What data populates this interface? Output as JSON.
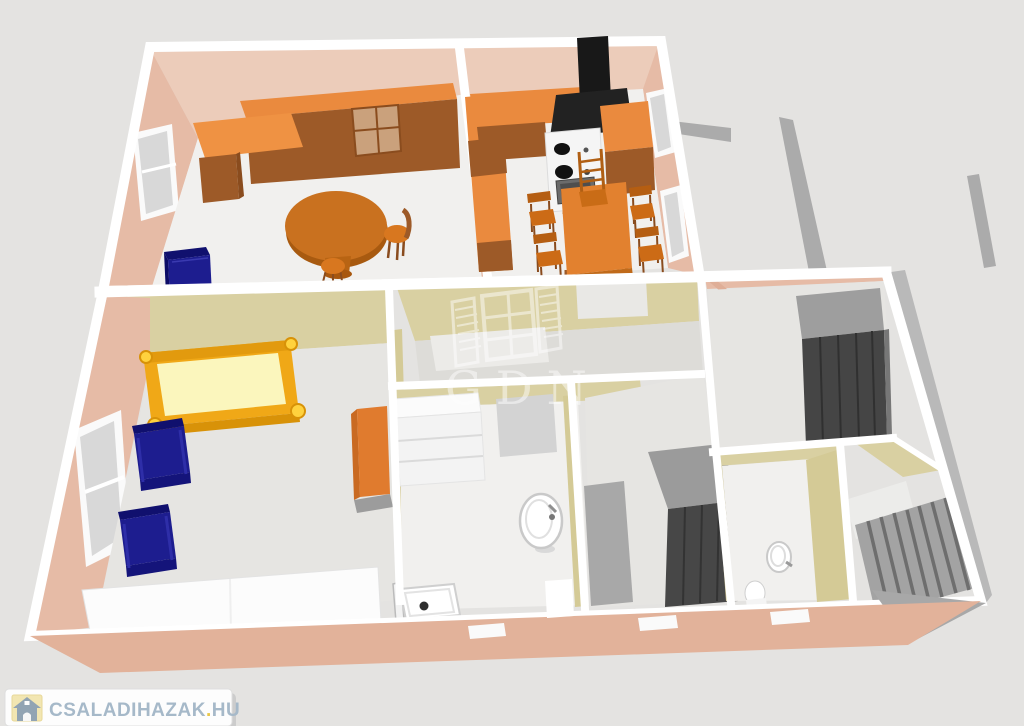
{
  "page": {
    "background_color": "#e4e3e1",
    "description": "3D rendered floor plan of a family house, viewed from above"
  },
  "watermark": {
    "text": "GDN",
    "icon": "window-with-shutters-icon",
    "color": "#ffffff",
    "opacity": 0.48
  },
  "branding": {
    "site_name": "CSALADIHAZAK",
    "separator": ".",
    "tld": "HU",
    "icon": "house-icon",
    "text_color": "#a6b9c9",
    "dot_color": "#e9c748",
    "icon_bg_color": "#f2e6b2",
    "pill_color": "#fdfdfd"
  },
  "scene": {
    "type": "3d-floor-plan",
    "rooms": [
      "living-room",
      "kitchen-dining",
      "bedroom",
      "walk-in-closet",
      "bathroom",
      "hallway",
      "dressing-room",
      "wc",
      "staircase"
    ],
    "furniture": [
      "wall-cabinets",
      "desk",
      "round-table",
      "chair",
      "stool",
      "blue-cabinet",
      "kitchen-counters",
      "stove",
      "range-hood",
      "dining-table",
      "dining-chairs",
      "bed",
      "armchair",
      "armchair",
      "orange-cabinet",
      "white-sideboard",
      "dresser",
      "washbasin",
      "shower-tray",
      "grey-wardrobe",
      "corner-wardrobe",
      "rug",
      "small-washbasin",
      "toilet",
      "stairs"
    ]
  },
  "colors": {
    "wall_top": "#ffffff",
    "exterior_wall_salmon": "#e6bba6",
    "front_wall_cut": "#e2b29a",
    "interior_wall_khaki": "#d9d0a2",
    "floor_light": "#f1f0ee",
    "floor_grey": "#e6e5e2",
    "furniture_orange": "#ea8a3e",
    "furniture_brown": "#9d5a28",
    "furniture_navy": "#1d1d8f",
    "bed_yellow_frame": "#f0a817",
    "bed_mattress": "#fbf6bd",
    "wardrobe_grey": "#474747",
    "terrace_wall_grey": "#ababab",
    "hood_black": "#1b1b1b"
  }
}
